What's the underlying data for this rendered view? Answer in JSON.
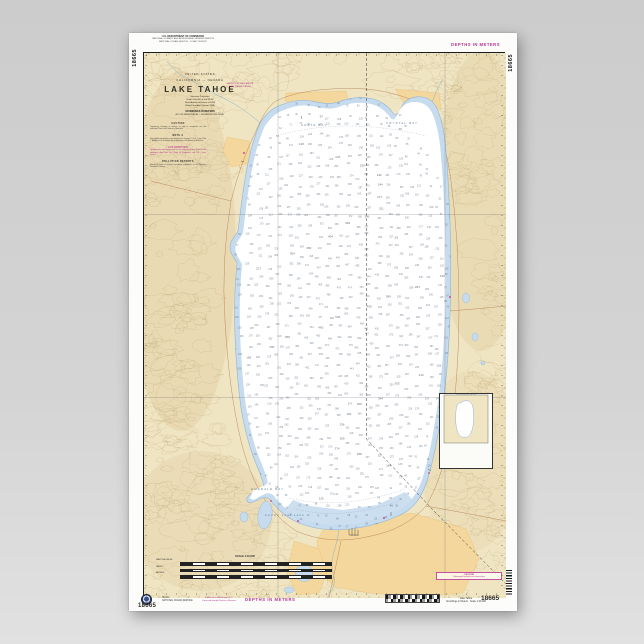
{
  "chart_number": "18665",
  "depths_label": "DEPTHS IN METERS",
  "top_block": {
    "heading": "U.S. DEPARTMENT OF COMMERCE",
    "line1": "NATIONAL OCEANIC AND ATMOSPHERIC ADMINISTRATION",
    "line2": "NATIONAL OCEAN SERVICE · COAST SURVEY"
  },
  "title_block": {
    "country": "UNITED STATES",
    "region": "CALIFORNIA — NEVADA",
    "title": "LAKE TAHOE",
    "sub1": "Mercator Projection",
    "sub2": "Scale 1:40,000 at Lat 39°05'",
    "sub3": "North American Datum of 1983",
    "sub4": "(World Geodetic System 1984)",
    "soundings": "SOUNDINGS IN METERS",
    "datum_note": "AT LOW WATER DATUM — ELEVATION 6223.0 FEET"
  },
  "stamp": {
    "line1": "HEIGHTS IN FEET ABOVE",
    "line2": "LOW WATER DATUM"
  },
  "notes": [
    {
      "heading": "CAUTION",
      "body": "Temporary changes or defects in aids to navigation are not indicated. See Local Notice to Mariners."
    },
    {
      "heading": "NOTE A",
      "body": "Navigation regulations are published in Chapter 2, U.S. Coast Pilot 7. Additions or revisions are published in the Notice to Mariners."
    },
    {
      "heading": "AUTHORITIES",
      "body": "Hydrography and topography by the National Ocean Service with additional data from the Corps of Engineers and U.S. Coast Guard."
    },
    {
      "heading": "POLLUTION REPORTS",
      "body": "Report all spills of oil and hazardous substances to the National Response Center."
    }
  ],
  "scale_block": {
    "heading": "SCALE 1:40,000",
    "bars": [
      {
        "label": "NAUTICAL MILES"
      },
      {
        "label": "YARDS"
      },
      {
        "label": "METERS"
      }
    ]
  },
  "caution_box": {
    "title": "CAUTION",
    "line": "Submerged hazards exist along shore"
  },
  "inset": {
    "title": "SOURCE DIAGRAM",
    "lines": [
      "Consult the diagram for the",
      "source and date of surveys",
      "used in this compilation"
    ]
  },
  "bottom_margin": {
    "agency1": "NOAA",
    "agency2": "NATIONAL OCEAN SERVICE",
    "pub1": "Published at Washington, D.C.",
    "pub2": "Corrected through Notice to Mariners",
    "right_title": "Lake Tahoe",
    "right_sub": "Soundings in Meters · Scale 1:40,000"
  },
  "bay_labels": [
    {
      "text": "AGATE BAY",
      "x": 300,
      "y": 125
    },
    {
      "text": "CRYSTAL BAY",
      "x": 385,
      "y": 123
    },
    {
      "text": "EMERALD BAY",
      "x": 250,
      "y": 489
    },
    {
      "text": "Fallen Leaf Lake",
      "x": 264,
      "y": 515
    }
  ],
  "colors": {
    "land_tan": "#efe5c2",
    "contour_brown": "#b2945f",
    "shallow_blue": "#c6dcee",
    "water_stroke": "#8fb4d6",
    "deep_white": "#ffffff",
    "noaa_magenta": "#c2519f",
    "urban_yellow": "#f5d79b",
    "sounding_gray": "#66788a",
    "neatline_black": "#1c1c1c"
  },
  "map_generator": {
    "seed": 1337,
    "contour_count": 360,
    "sounding_step": 10,
    "max_depth": 501,
    "roses": [
      {
        "cx": 341,
        "cy": 222,
        "r": 27
      },
      {
        "cx": 331,
        "cy": 414,
        "r": 31
      }
    ],
    "calib_cells": 44
  }
}
